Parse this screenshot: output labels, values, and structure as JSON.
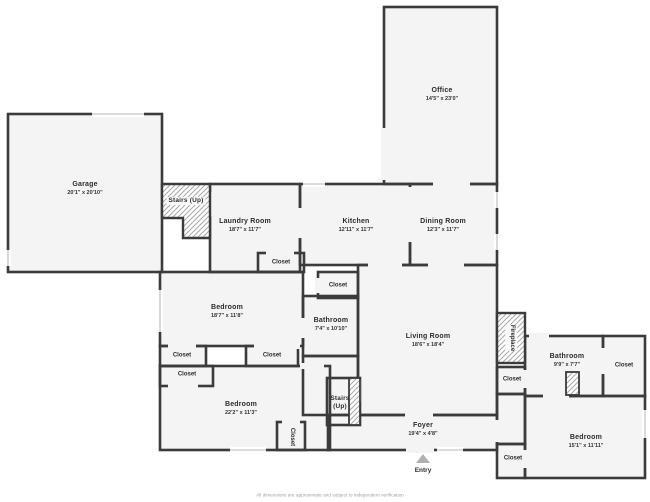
{
  "disclaimer": "All dimensions are approximate and subject to independent verification",
  "labels": {
    "closet": "Closet",
    "entry": "Entry",
    "stairs_up": "Stairs (Up)",
    "fireplace": "Fireplace"
  },
  "rooms": {
    "garage": {
      "name": "Garage",
      "dims": "20'1\" x 20'10\""
    },
    "laundry": {
      "name": "Laundry Room",
      "dims": "18'7\" x 11'7\""
    },
    "kitchen": {
      "name": "Kitchen",
      "dims": "12'11\" x 11'7\""
    },
    "dining": {
      "name": "Dining Room",
      "dims": "12'3\" x 11'7\""
    },
    "office": {
      "name": "Office",
      "dims": "14'5\" x 23'0\""
    },
    "bedroom1": {
      "name": "Bedroom",
      "dims": "18'7\" x 11'8\""
    },
    "bathroom1": {
      "name": "Bathroom",
      "dims": "7'4\" x 10'10\""
    },
    "living": {
      "name": "Living Room",
      "dims": "18'6\" x 18'4\""
    },
    "bedroom2": {
      "name": "Bedroom",
      "dims": "22'2\" x 11'3\""
    },
    "foyer": {
      "name": "Foyer",
      "dims": "19'4\" x 4'8\""
    },
    "bathroom2": {
      "name": "Bathroom",
      "dims": "9'9\" x 7'7\""
    },
    "bedroom3": {
      "name": "Bedroom",
      "dims": "15'1\" x 11'11\""
    }
  },
  "colors": {
    "wall": "#3b3b3b",
    "floor": "#f4f4f4",
    "hatch_line": "#a8a8a8",
    "window": "#c7c7c7",
    "background": "#ffffff"
  }
}
